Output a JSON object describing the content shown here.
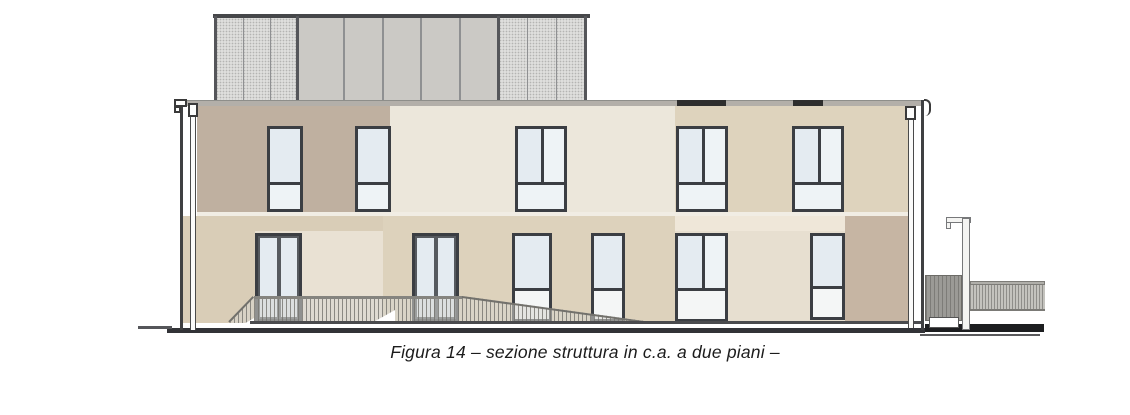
{
  "figure": {
    "caption": "Figura 14 – sezione struttura in c.a. a due piani –",
    "kind": "architectural elevation drawing",
    "building": {
      "floors_visible": 2,
      "upper_floor_windows": 5,
      "ground_floor_openings": 6,
      "rooftop_screen_panels": 3,
      "terrace_railing": true,
      "right_side_elements": [
        "gate panel",
        "pole",
        "fence"
      ]
    }
  },
  "colors": {
    "facade_taupe_upper": "#bfb0a0",
    "facade_cream_upper": "#ece7db",
    "facade_beige_upper": "#ded3bd",
    "facade_ground_beige": "#d9cdb7",
    "facade_ground_cream": "#e9e1d3",
    "facade_ground_mid": "#ddd2bc",
    "facade_ground_cream2": "#e7dfd0",
    "facade_ground_taupe": "#c6b5a3",
    "window_frame": "#3b3e43",
    "glass": "#e4ebf1",
    "roof_panel": "#cbc9c5",
    "roof_mesh": "#dededc",
    "parapet": "#b3afa9",
    "ground_dark": "#323337",
    "caption_color": "#1c1c1c"
  }
}
